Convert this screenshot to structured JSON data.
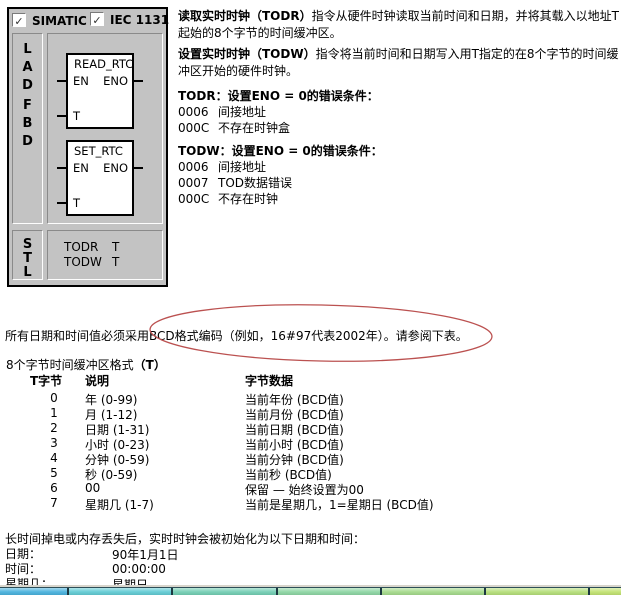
{
  "panel": {
    "check_glyph": "✓",
    "checkboxes": [
      {
        "label": "SIMATIC",
        "checked": true
      },
      {
        "label": "IEC 1131",
        "checked": true
      }
    ],
    "lad_fbd_letters": [
      "L",
      "A",
      "D",
      "F",
      "B",
      "D"
    ],
    "stl_letters": [
      "S",
      "T",
      "L"
    ],
    "blocks": [
      {
        "title": "READ_RTC",
        "pin_en": "EN",
        "pin_eno": "ENO",
        "pin_t": "T"
      },
      {
        "title": "SET_RTC",
        "pin_en": "EN",
        "pin_eno": "ENO",
        "pin_t": "T"
      }
    ],
    "stl_lines": [
      {
        "op": "TODR",
        "arg": "T"
      },
      {
        "op": "TODW",
        "arg": "T"
      }
    ]
  },
  "description": {
    "para1_bold": "读取实时时钟（TODR）",
    "para1_rest": "指令从硬件时钟读取当前时间和日期，并将其载入以地址T起始的8个字节的时间缓冲区。",
    "para2_bold": "设置实时时钟（TODW）",
    "para2_rest": "指令将当前时间和日期写入用T指定的在8个字节的时间缓冲区开始的硬件时钟。",
    "todr_heading": "TODR：设置ENO = 0的错误条件：",
    "todr_errors": [
      {
        "code": "0006",
        "text": "间接地址"
      },
      {
        "code": "000C",
        "text": "不存在时钟盒"
      }
    ],
    "todw_heading": "TODW：设置ENO = 0的错误条件：",
    "todw_errors": [
      {
        "code": "0006",
        "text": "间接地址"
      },
      {
        "code": "0007",
        "text": "TOD数据错误"
      },
      {
        "code": "000C",
        "text": "不存在时钟"
      }
    ]
  },
  "bcd_note": "所有日期和时间值必须采用BCD格式编码（例如，16#97代表2002年）。请参阅下表。",
  "table": {
    "caption_plain": "8个字节时间缓冲区格式",
    "caption_bold": "（T）",
    "headers": [
      "T字节",
      "说明",
      "字节数据"
    ],
    "rows": [
      [
        "0",
        "年 (0-99)",
        "当前年份 (BCD值)"
      ],
      [
        "1",
        "月 (1-12)",
        "当前月份 (BCD值)"
      ],
      [
        "2",
        "日期 (1-31)",
        "当前日期 (BCD值)"
      ],
      [
        "3",
        "小时 (0-23)",
        "当前小时 (BCD值)"
      ],
      [
        "4",
        "分钟 (0-59)",
        "当前分钟 (BCD值)"
      ],
      [
        "5",
        "秒 (0-59)",
        "当前秒 (BCD值)"
      ],
      [
        "6",
        "00",
        "保留 — 始终设置为00"
      ],
      [
        "7",
        "星期几 (1-7)",
        "当前是星期几，1=星期日 (BCD值)"
      ]
    ]
  },
  "defaults": {
    "intro": "长时间掉电或内存丢失后，实时时钟会被初始化为以下日期和时间：",
    "rows": [
      {
        "label": "日期：",
        "value": "90年1月1日"
      },
      {
        "label": "时间：",
        "value": "00:00:00"
      },
      {
        "label": "星期几：",
        "value": "星期日"
      }
    ]
  },
  "annotation": {
    "color": "#bb5150"
  },
  "taskbar": {
    "segments": [
      "#4ab2dd",
      "#62cbd4",
      "#74ceb4",
      "#8ed6a4",
      "#a5da8c",
      "#b5de7a",
      "#c2e272"
    ]
  }
}
